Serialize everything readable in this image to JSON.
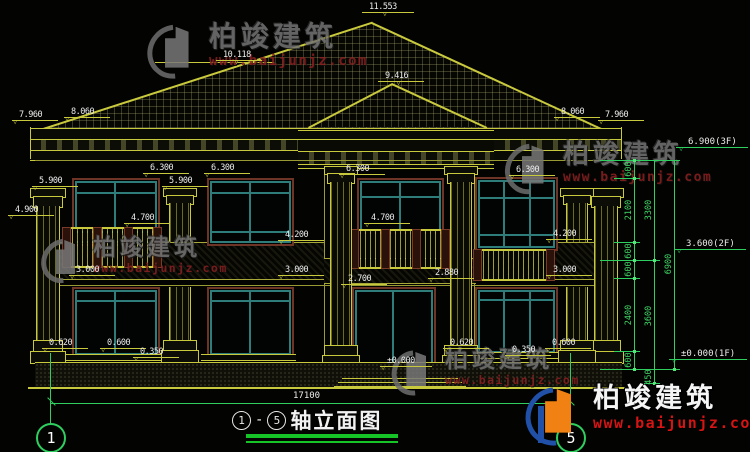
{
  "drawing": {
    "title": "轴立面图",
    "axis_start": "1",
    "axis_end": "5",
    "separator": "-",
    "total_width_dim": "17100"
  },
  "levels": [
    "11.553",
    "10.118",
    "9.416",
    "7.960",
    "8.060",
    "8.060",
    "7.960",
    "5.900",
    "6.300",
    "6.300",
    "5.900",
    "6.300",
    "6.300",
    "4.900",
    "4.700",
    "4.700",
    "4.200",
    "4.200",
    "3.000",
    "3.000",
    "3.000",
    "2.700",
    "2.880",
    "±0.000",
    "0.620",
    "0.600",
    "0.350",
    "0.620",
    "0.350",
    "0.600"
  ],
  "floor_flags": [
    "6.900(3F)",
    "3.600(2F)",
    "±0.000(1F)"
  ],
  "v_dims": [
    "600",
    "2100",
    "600",
    "600",
    "2400",
    "600",
    "450",
    "3300",
    "3600",
    "6900"
  ],
  "watermark": {
    "brand": "柏竣建筑",
    "url": "www.baijunjz.com"
  },
  "colors": {
    "cad_yellow": "#c9c93e",
    "cad_green": "#2fcf5f",
    "window_teal": "#2e7d7a",
    "frame_brown": "#7a3a28",
    "logo_blue": "#2050a8",
    "logo_orange": "#f08112",
    "url_red": "#b22222"
  }
}
